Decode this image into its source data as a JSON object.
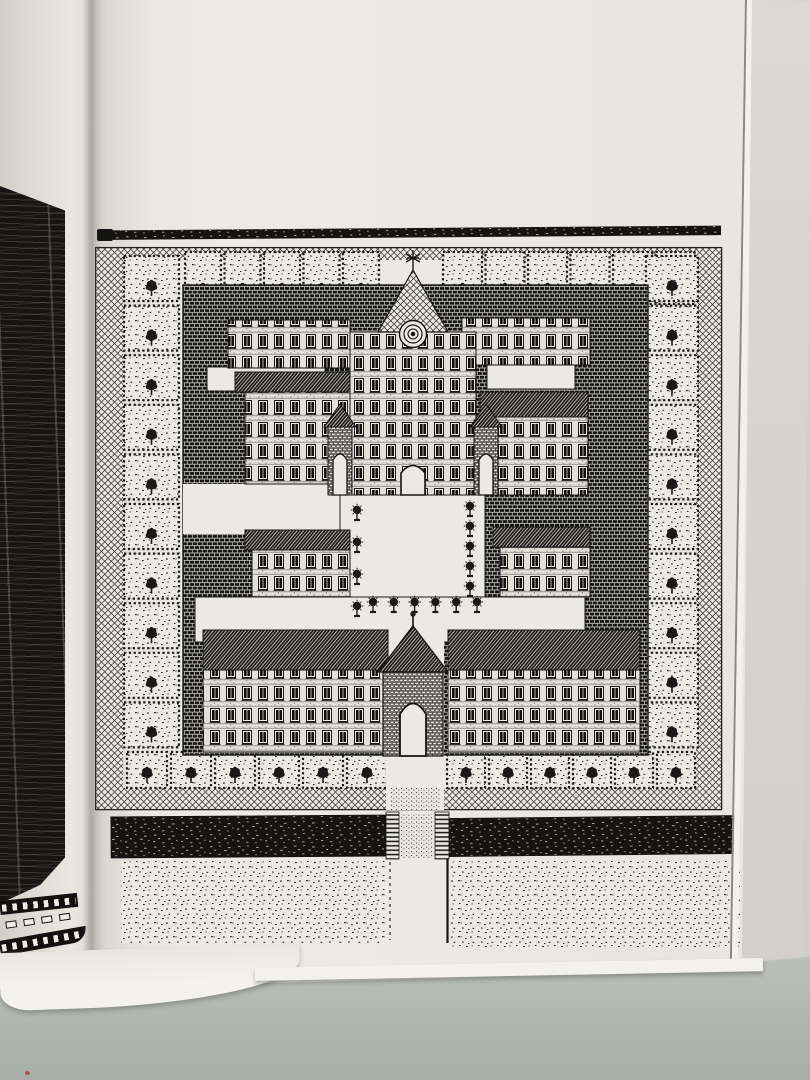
{
  "colors": {
    "ink": "#1a1918",
    "paper": "#ebe9e3",
    "black_page": "#161513",
    "backdrop": "#d9d6d1",
    "sill": "#b7bbb5",
    "page_edge": "#f2f1ed",
    "edge_line": "#8a8984",
    "speck": "#a34a42"
  },
  "drawing": {
    "garden_groups": [
      {
        "id": "garden-top-left",
        "n": 5,
        "x0": 90,
        "y0": 32,
        "dx": 39.5,
        "dy": 0,
        "w": 36,
        "h": 52
      },
      {
        "id": "garden-top-right",
        "n": 6,
        "x0": 348,
        "y0": 32,
        "dx": 42.5,
        "dy": 0,
        "w": 39,
        "h": 52
      },
      {
        "id": "garden-left",
        "n": 10,
        "x0": 29,
        "y0": 36,
        "dx": 0,
        "dy": 49.6,
        "w": 55,
        "h": 45
      },
      {
        "id": "garden-right",
        "n": 10,
        "x0": 551,
        "y0": 36,
        "dx": 0,
        "dy": 49.6,
        "w": 52,
        "h": 45
      },
      {
        "id": "garden-bottom-left",
        "n": 6,
        "x0": 32,
        "y0": 532,
        "dx": 44,
        "dy": 0,
        "w": 40,
        "h": 36
      },
      {
        "id": "garden-bottom-right",
        "n": 6,
        "x0": 352,
        "y0": 532,
        "dx": 42,
        "dy": 0,
        "w": 38,
        "h": 36
      }
    ],
    "topiary_groups": [
      {
        "id": "topiary-left",
        "n": 4,
        "x0": 262,
        "y0": 300,
        "dx": 0,
        "dy": 32
      },
      {
        "id": "topiary-right",
        "n": 5,
        "x0": 375,
        "y0": 296,
        "dx": 0,
        "dy": 20
      },
      {
        "id": "topiary-bottom",
        "n": 6,
        "x0": 278,
        "y0": 392,
        "dx": 20.8,
        "dy": 0
      }
    ]
  }
}
